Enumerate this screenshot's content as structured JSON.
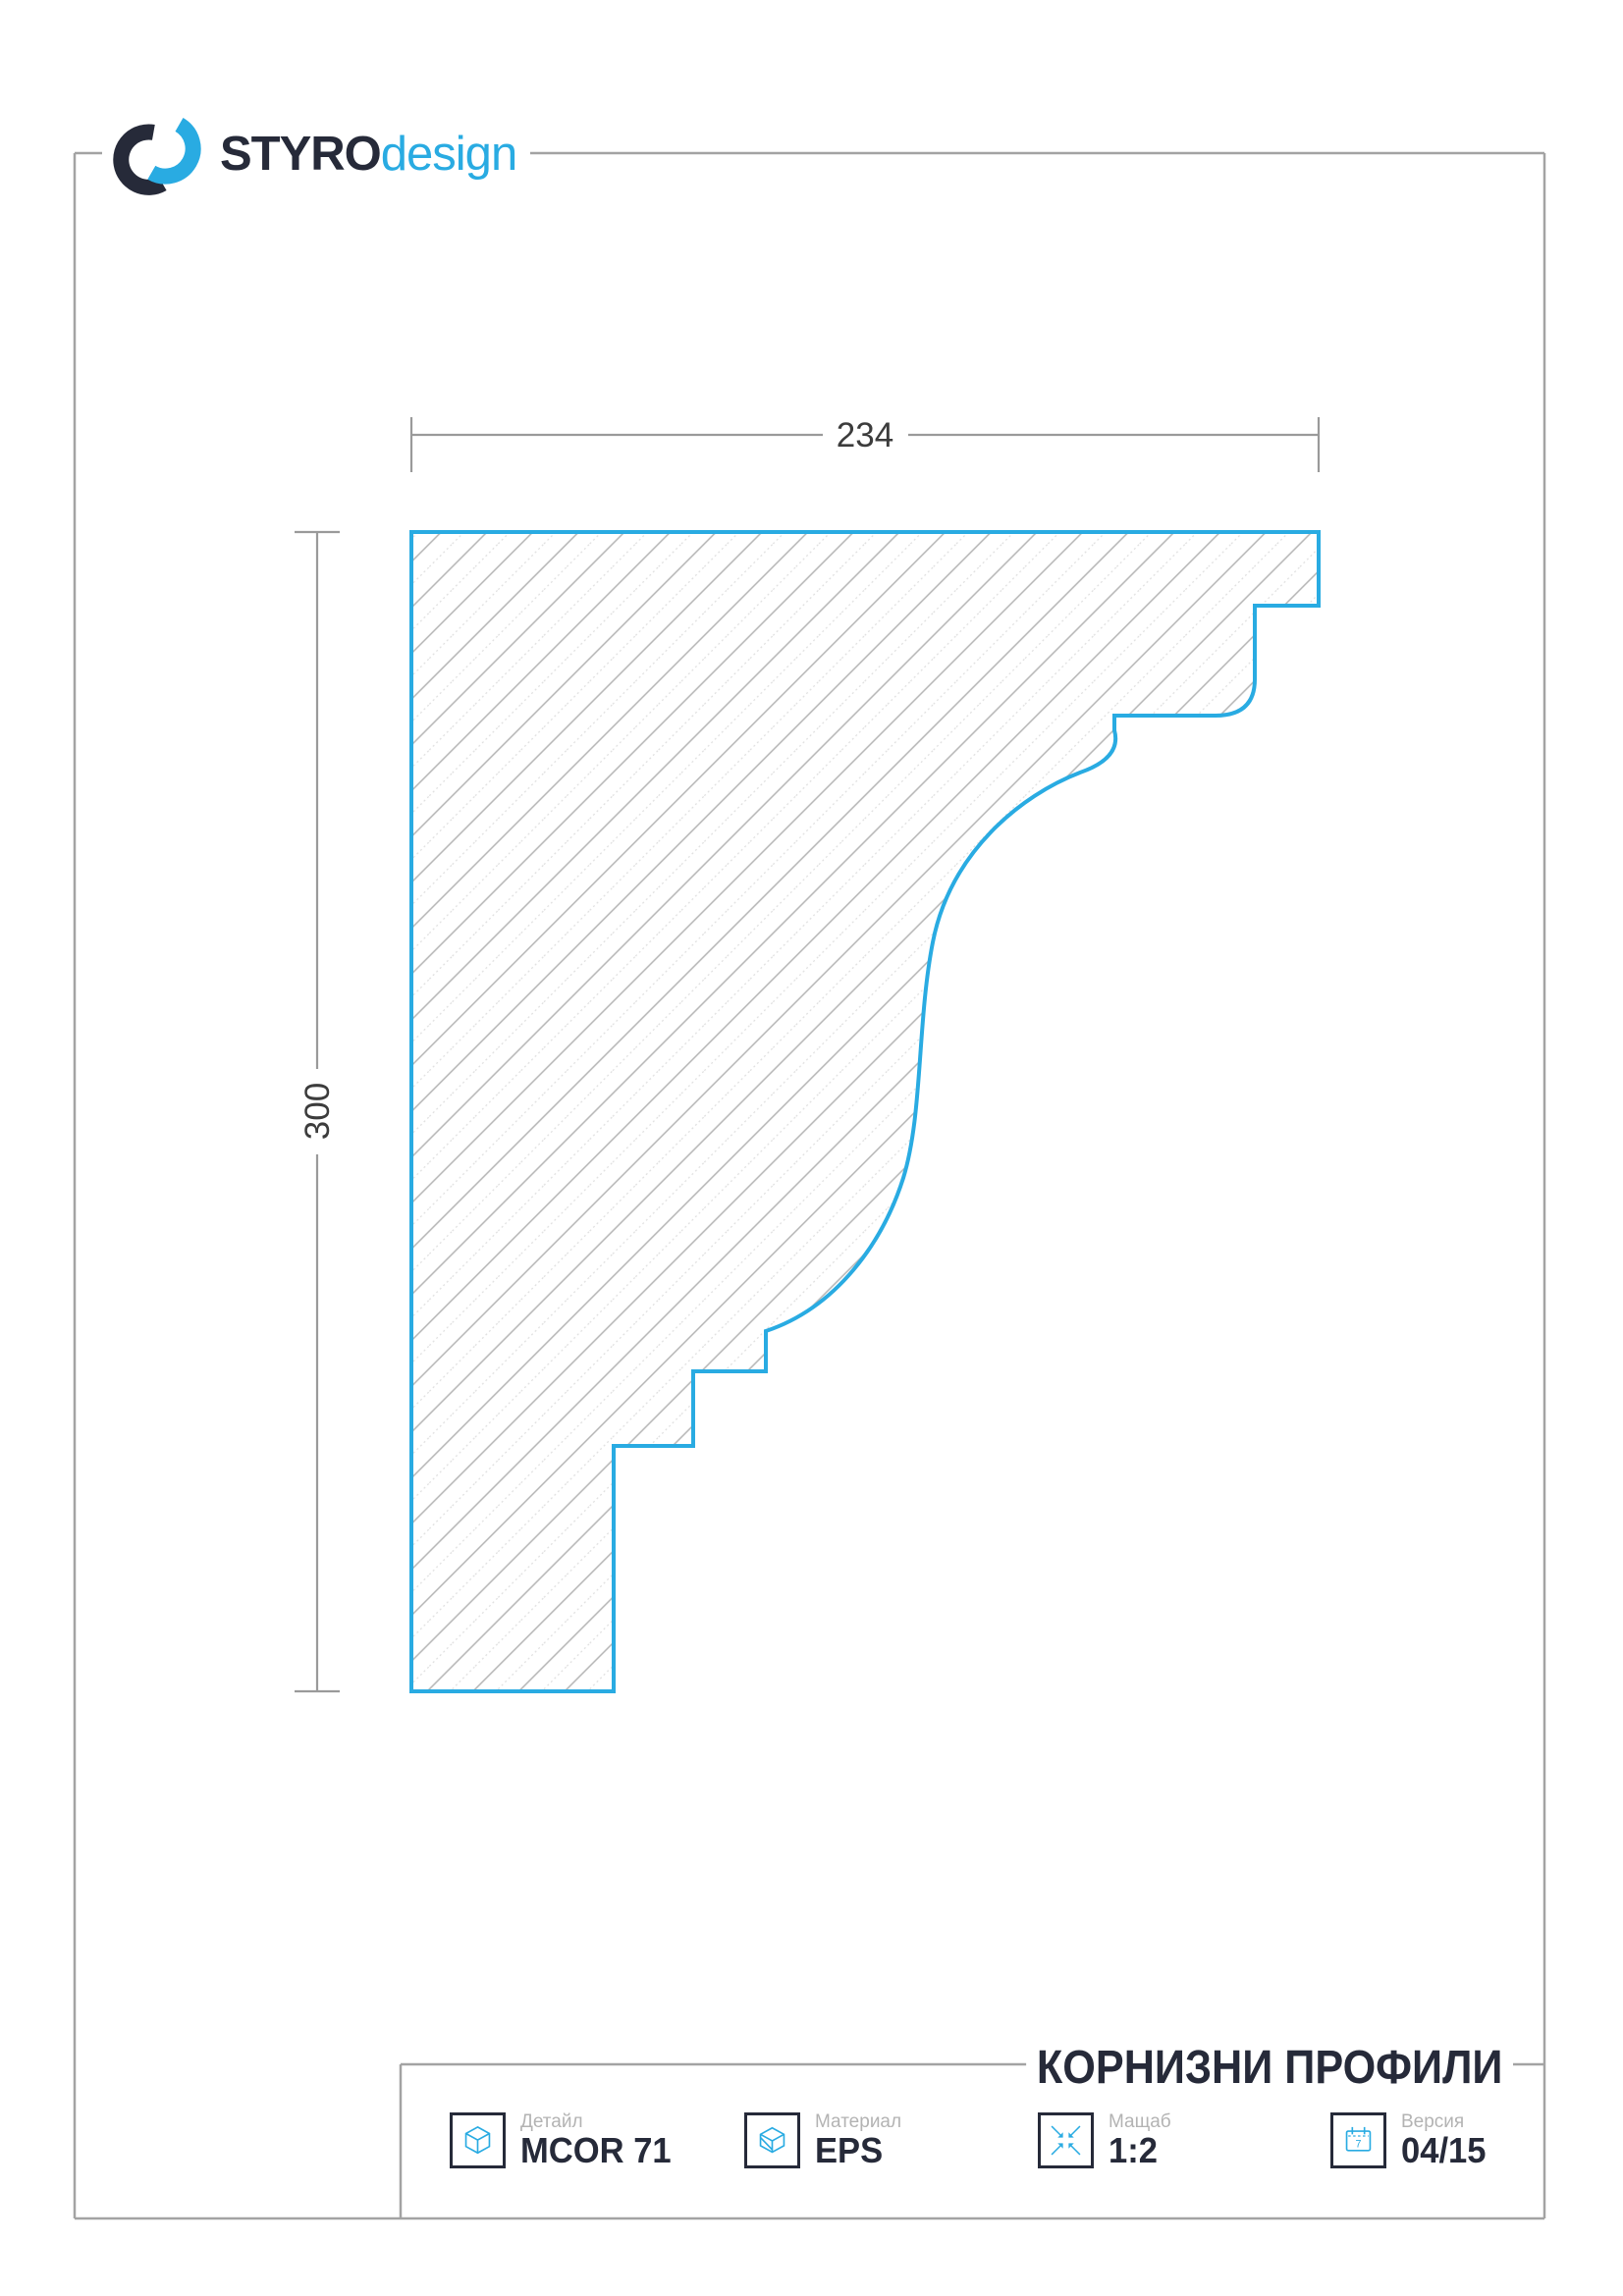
{
  "logo": {
    "brand": "STYRO",
    "brand_suffix": "design",
    "icon": "styro-sync-logo"
  },
  "drawing": {
    "subject": "cornice profile cross-section",
    "dim_width": "234",
    "dim_height": "300"
  },
  "footer": {
    "title": "КОРНИЗНИ ПРОФИЛИ",
    "items": [
      {
        "label": "Детайл",
        "value": "MCOR 71",
        "icon": "cube-icon"
      },
      {
        "label": "Материал",
        "value": "EPS",
        "icon": "material-block-icon"
      },
      {
        "label": "Мащаб",
        "value": "1:2",
        "icon": "scale-arrows-icon"
      },
      {
        "label": "Версия",
        "value": "04/15",
        "icon": "calendar-icon",
        "icon_digit": "7"
      }
    ]
  },
  "colors": {
    "accent_blue": "#29abe2",
    "dark_navy": "#262a39",
    "frame_gray": "#a3a3a3",
    "hatch_gray": "#b4b4b4",
    "dim_text": "#3c3c3c",
    "label_gray": "#b3b3b3"
  }
}
